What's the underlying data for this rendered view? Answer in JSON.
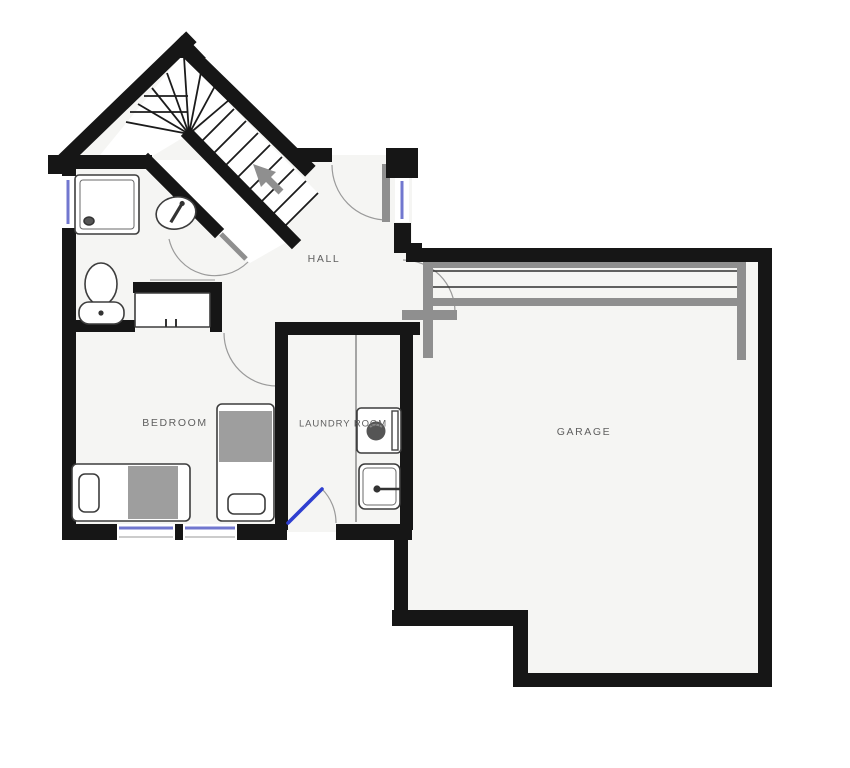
{
  "plan": {
    "rooms": {
      "hall": {
        "label": "HALL"
      },
      "bedroom": {
        "label": "BEDROOM"
      },
      "laundry": {
        "label": "LAUNDRY ROOM"
      },
      "garage": {
        "label": "GARAGE"
      }
    },
    "colors": {
      "wall": "#161616",
      "floor": "#f5f5f3",
      "fixture_gray": "#8f8f8f",
      "window_blue": "#7177cf",
      "door_blue": "#2f3fd0",
      "label_text": "#5f5f5f",
      "background": "#ffffff"
    }
  }
}
